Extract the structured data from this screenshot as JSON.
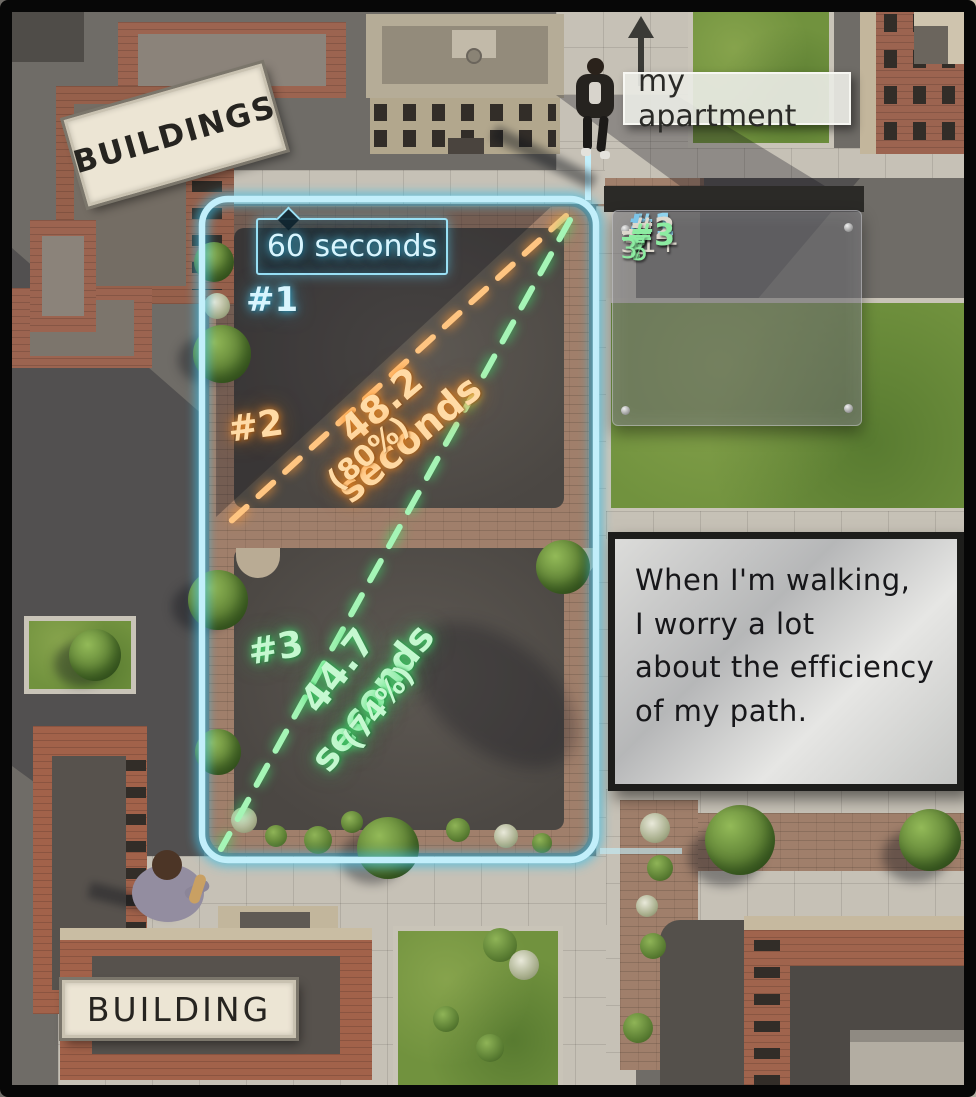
{
  "signs": {
    "buildings": "BUILDINGS",
    "building": "BUILDING",
    "apartment": "my apartment"
  },
  "paths": {
    "p1": {
      "id": "#1",
      "time": "60 seconds",
      "color": "#b7ecfb"
    },
    "p2": {
      "id": "#2",
      "time": "48.2 seconds",
      "percent": "(80%)",
      "color": "#ffb056"
    },
    "p3": {
      "id": "#3",
      "time": "44.7 seconds",
      "percent": "(74%)",
      "color": "#7af08e"
    }
  },
  "formulas": {
    "f1": {
      "id": "#1",
      "eq": "=",
      "rhs": "t"
    },
    "f2": {
      "id": "#2",
      "eq": "=",
      "num_t": "t",
      "num_open": "(1+",
      "radical": "√",
      "radicand": "2",
      "num_close": ")",
      "den": "3"
    },
    "f3": {
      "id": "#3",
      "eq": "=",
      "num_t": "t",
      "radical": "√",
      "radicand": "5",
      "den": "3"
    }
  },
  "note": {
    "line1": "When I'm walking,",
    "line2": "I worry a lot",
    "line3": "about the efficiency",
    "line4": "of my path."
  }
}
